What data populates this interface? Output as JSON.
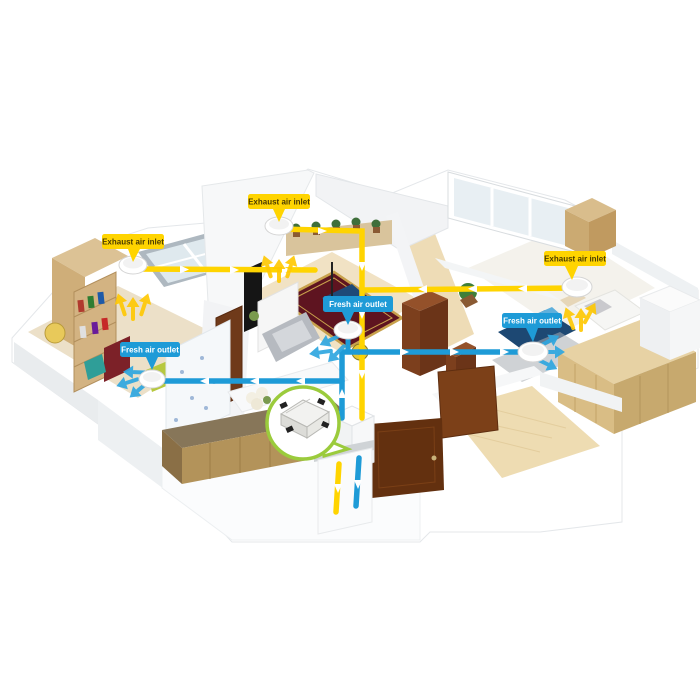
{
  "diagram": {
    "labels": [
      {
        "text": "Exhaust air inlet",
        "type": "exhaust"
      },
      {
        "text": "Exhaust air inlet",
        "type": "exhaust"
      },
      {
        "text": "Exhaust air inlet",
        "type": "exhaust"
      },
      {
        "text": "Fresh air outlet",
        "type": "fresh"
      },
      {
        "text": "Fresh air outlet",
        "type": "fresh"
      },
      {
        "text": "Fresh air outlet",
        "type": "fresh"
      }
    ],
    "colors": {
      "exhaust_duct": "#FFD400",
      "fresh_duct": "#1E9BD7",
      "exhaust_label_bg": "#FFD400",
      "exhaust_label_text": "#4A3B00",
      "fresh_label_bg": "#1E9BD7",
      "fresh_label_text": "#FFFFFF",
      "callout_ring": "#9BCB3C",
      "background": "#FFFFFF"
    }
  }
}
